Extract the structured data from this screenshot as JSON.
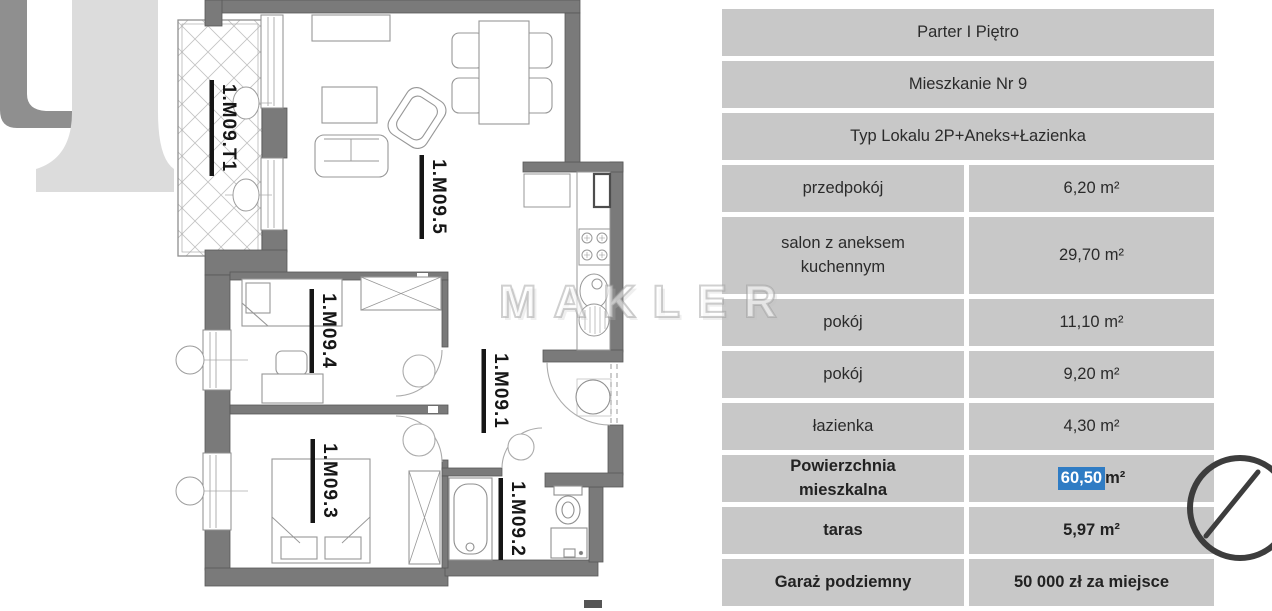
{
  "floor_plan": {
    "watermark_text": "MAKLER",
    "room_labels": [
      {
        "id": "terrace",
        "label": "1.M09.T1"
      },
      {
        "id": "living-room",
        "label": "1.M09.5"
      },
      {
        "id": "bedroom-1",
        "label": "1.M09.4"
      },
      {
        "id": "hallway",
        "label": "1.M09.1"
      },
      {
        "id": "bedroom-2",
        "label": "1.M09.3"
      },
      {
        "id": "bathroom",
        "label": "1.M09.2"
      }
    ],
    "icons": {
      "compass": "compass-north-icon",
      "logo": "brand-logo-watermark"
    }
  },
  "table": {
    "rows": [
      {
        "text": "Parter I Piętro"
      },
      {
        "text": "Mieszkanie Nr 9"
      },
      {
        "text": "Typ Lokalu 2P+Aneks+Łazienka"
      },
      {
        "label": "przedpokój",
        "value": "6,20 m²"
      },
      {
        "label": "salon z aneksem kuchennym",
        "value": "29,70 m²"
      },
      {
        "label": "pokój",
        "value": "11,10 m²"
      },
      {
        "label": "pokój",
        "value": "9,20 m²"
      },
      {
        "label": "łazienka",
        "value": "4,30 m²"
      },
      {
        "label": "Powierzchnia mieszkalna",
        "value_selected": "60,50",
        "value_rest": " m²"
      },
      {
        "label": "taras",
        "value": "5,97 m²"
      },
      {
        "label": "Garaż podziemny",
        "value": "50 000 zł za miejsce"
      }
    ]
  },
  "colors": {
    "cell_bg": "#c8c8c8",
    "selection_bg": "#2f7cc4",
    "wall": "#7a7a7a",
    "text": "#2b2b2b",
    "compass": "#3d3d3d"
  }
}
